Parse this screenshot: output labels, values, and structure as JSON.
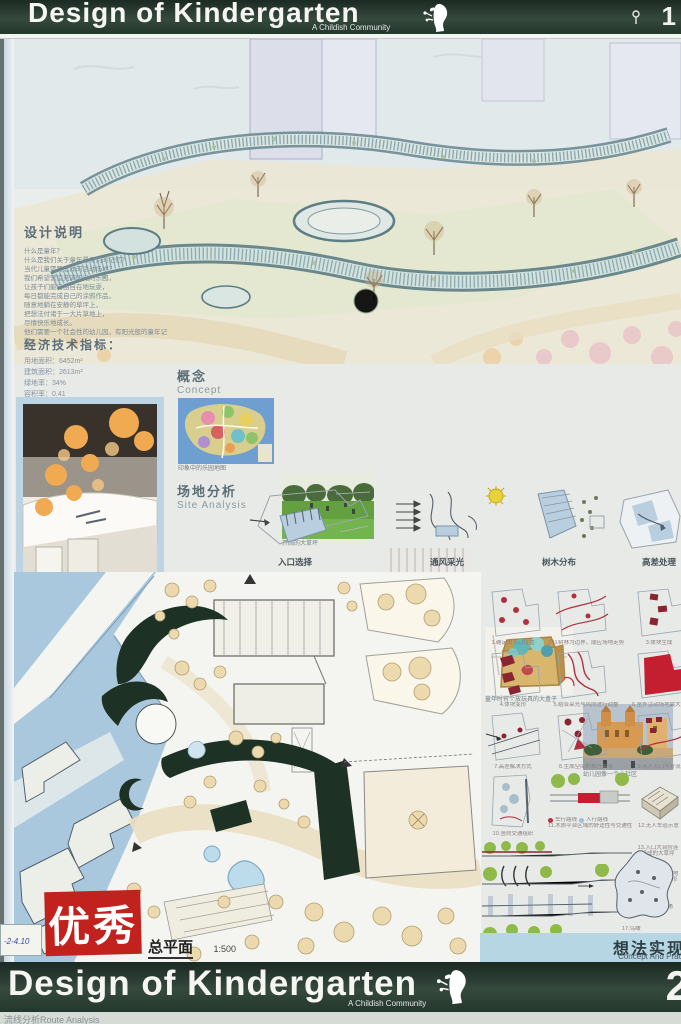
{
  "header": {
    "title": "Design of Kindergarten",
    "subtitle": "A Childish Community",
    "page": "1"
  },
  "footer": {
    "title": "Design of Kindergarten",
    "subtitle": "A Childish Community",
    "page": "2",
    "strip_text": "流线分析Route Analysis"
  },
  "design_notes": {
    "heading": "设计说明",
    "lines": [
      "什么是童年？",
      "什么是我们关于童年最深刻的记忆？",
      "当代儿童需要怎样的活动场地？",
      "我们希望营造充满阳光的乐园，",
      "让孩子们能自由自在地玩耍，",
      "每日都能完成自己的涂鸦作品，",
      "随意地躺在安静的草坪上，",
      "把想法付诸于一大片草地上，",
      "尽情快乐地成长。",
      "他们需要一个社会性的幼儿园，有阳光般的童年记忆。"
    ]
  },
  "indicators": {
    "heading": "经济技术指标：",
    "items": [
      "用地面积：6452m²",
      "建筑面积：2613m²",
      "绿地率：34%",
      "容积率：0.41"
    ]
  },
  "concept": {
    "heading_cn": "概念",
    "heading_en": "Concept",
    "images": [
      {
        "name": "playground-map-photo",
        "caption": "印象中的乐园地图"
      },
      {
        "name": "lawn-park-photo",
        "caption": "开阔的大草坪"
      },
      {
        "name": "exhibition-interior-photo",
        "caption": "创意展示空间"
      },
      {
        "name": "toy-box-photo",
        "caption": "童年时有个放玩具的大盒子"
      },
      {
        "name": "church-community-photo",
        "caption": "幼儿园像一个小社区"
      }
    ]
  },
  "site_analysis": {
    "heading_cn": "场地分析",
    "heading_en": "Site Analysis",
    "labels": [
      "入口选择",
      "通风采光",
      "树木分布",
      "高差处理"
    ]
  },
  "master_plan": {
    "stamp": "优秀",
    "label": "总平面",
    "scale": "1:500",
    "tag": "-2-4.10"
  },
  "process": {
    "items": [
      "1.确定出入口位置",
      "2.以树林为边界，顺应场地走势",
      "3.体块生成",
      "4.体块变形",
      "5.结合采光与风向进行调整",
      "6.室外活动场地最大化",
      "7.高差解决方式",
      "8.生成空间的相互关系",
      "9.无人入口与分流",
      "10.竖向交通组织",
      "11.木质平台区域的舒适性与交通性相结合",
      "12.无人车道示意",
      "13.入口大台阶连接成的大草坪",
      "14.缓坡连接场地高差，顺应地形",
      "15.屋顶交通",
      "16.坡道",
      "17.鸟瞰"
    ],
    "legend": [
      "车行路线",
      "人行路线"
    ]
  },
  "bottom_bar": {
    "cn": "想法实现",
    "en": "Concept And Practice"
  },
  "colors": {
    "banner_green": "#2e4337",
    "stamp_red": "#c2221e",
    "context_blue": "#a9c8de",
    "accent_red": "#b03040"
  }
}
